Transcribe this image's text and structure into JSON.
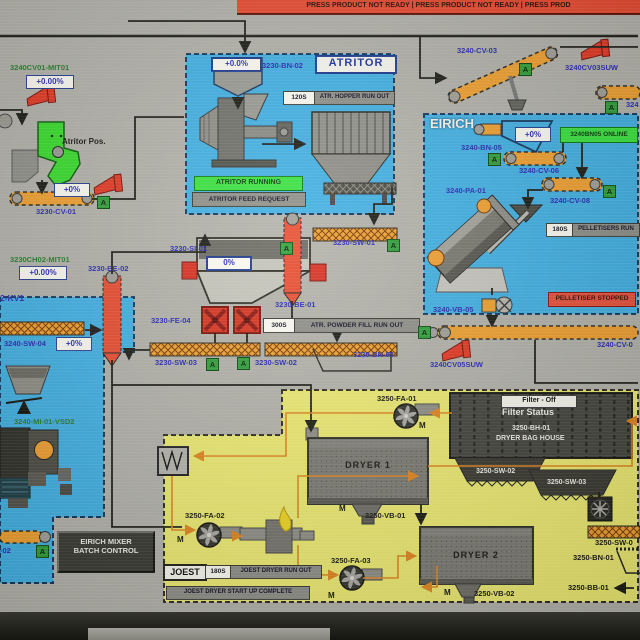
{
  "banner": {
    "text": "PRESS PRODUCT NOT READY      |      PRESS PRODUCT NOT READY      |      PRESS PROD"
  },
  "ind": {
    "auto": "A",
    "motor": "M"
  },
  "colors": {
    "screen_bg": "#b2b2aa",
    "panel_blue": "#41b0e2",
    "conveyor_orange": "#efa02f",
    "alarm_red": "#e8503a",
    "ok_green": "#39e23e",
    "joest_yellow": "#ecea70"
  },
  "topleft": {
    "mit01": "3240CV01-MIT01",
    "mit01_value": "+0.00%",
    "atritor_pos": "Atritor Pos.",
    "cv01_value": "+0%",
    "cv01": "3230-CV-01",
    "ch02": "3230CH02-MIT01",
    "ch02_value": "+0.00%",
    "kv1": "2-KV1"
  },
  "atritor": {
    "title": "ATRITOR",
    "bn02": "3230-BN-02",
    "bn02_value": "+0.0%",
    "timer": "120S",
    "runout_msg": "ATR. HOPPER RUN OUT",
    "running": "ATRITOR RUNNING",
    "feed_request": "ATRITOR FEED REQUEST"
  },
  "topright": {
    "cv03": "3240-CV-03",
    "cv03suw": "3240CV03SUW",
    "cv04_partial": "324"
  },
  "eirich": {
    "title": "EIRICH",
    "bn05": "3240-BN-05",
    "bn05_value": "+0%",
    "online": "3240BN05 ONLINE",
    "cv06": "3240-CV-06",
    "cv08": "3240-CV-08",
    "pa01": "3240-PA-01",
    "timer": "180S",
    "runout_msg": "PELLETISERS RUN",
    "stopped": "PELLETISER STOPPED",
    "vb05": "3240-VB-05"
  },
  "center": {
    "si01": "3230-SI-01",
    "si01_value": "0%",
    "be02": "3230-BE-02",
    "sw01": "3230-SW-01",
    "be01": "3230-BE-01",
    "fe04": "3230-FE-04",
    "timer": "300S",
    "runout_msg": "ATR. POWDER FILL RUN OUT",
    "sw03": "3230-SW-03",
    "sw02": "3230-SW-02",
    "bn03": "3230-BN-03"
  },
  "rightmid": {
    "cv05_partial": "3240-CV-0",
    "cv05suw": "3240CV05SUW"
  },
  "mixer": {
    "sw04": "3240-SW-04",
    "sw04_value": "+0%",
    "mi01": "3240-MI-01-VSD2",
    "batch_line1": "EIRICH MIXER",
    "batch_line2": "BATCH CONTROL",
    "cv02_partial": "-02"
  },
  "joest": {
    "title": "JOEST",
    "fa01": "3250-FA-01",
    "fa02": "3250-FA-02",
    "fa03": "3250-FA-03",
    "vb01": "3250-VB-01",
    "vb02": "3250-VB-02",
    "dryer1": "DRYER 1",
    "dryer2": "DRYER 2",
    "filter_off": "Filter - Off",
    "filter_status": "Filter Status",
    "bh01": "3250-BH-01",
    "bag_house": "DRYER BAG HOUSE",
    "sw02": "3250-SW-02",
    "sw03": "3250-SW-03",
    "sw01_partial": "3250-SW-0",
    "bn01": "3250-BN-01",
    "bb01": "3250-BB-01",
    "timer": "180S",
    "runout_msg": "JOEST DRYER RUN OUT",
    "startup_msg": "JOEST DRYER START UP COMPLETE"
  }
}
